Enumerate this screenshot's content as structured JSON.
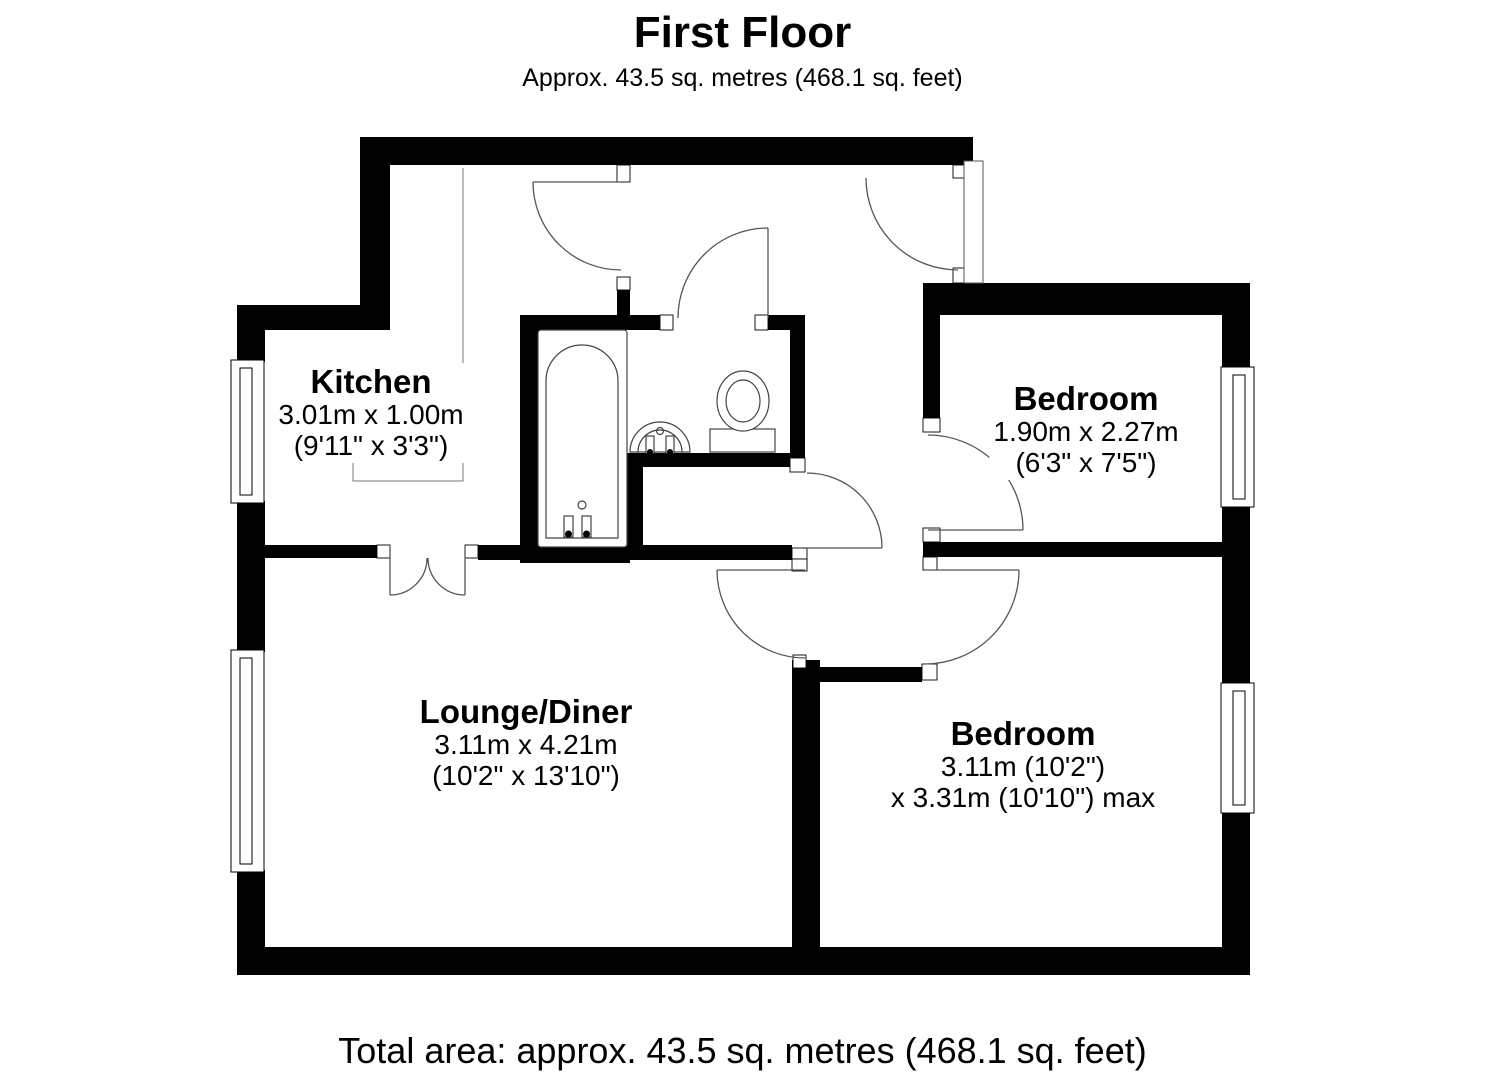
{
  "header": {
    "title": "First Floor",
    "subtitle": "Approx. 43.5 sq. metres (468.1 sq. feet)"
  },
  "footer": {
    "total_area": "Total area: approx. 43.5 sq. metres (468.1 sq. feet)"
  },
  "rooms": [
    {
      "id": "kitchen",
      "name": "Kitchen",
      "dimensions_metric": "3.01m x 1.00m",
      "dimensions_imperial": "(9'11\" x 3'3\")"
    },
    {
      "id": "bedroom-1",
      "name": "Bedroom",
      "dimensions_metric": "1.90m x 2.27m",
      "dimensions_imperial": "(6'3\" x 7'5\")"
    },
    {
      "id": "lounge-diner",
      "name": "Lounge/Diner",
      "dimensions_metric": "3.11m x 4.21m",
      "dimensions_imperial": "(10'2\" x 13'10\")"
    },
    {
      "id": "bedroom-2",
      "name": "Bedroom",
      "dimensions_metric": "3.11m (10'2\")",
      "dimensions_imperial": "x 3.31m (10'10\") max"
    }
  ],
  "fixtures": [
    "bathtub",
    "sink",
    "toilet"
  ],
  "openings": {
    "doors": 8,
    "windows": 4
  },
  "colors": {
    "walls": "#000000",
    "background": "#ffffff",
    "door_arc": "#555555",
    "fixture_line": "#444444",
    "kitchen_boundary_line": "#777777"
  }
}
